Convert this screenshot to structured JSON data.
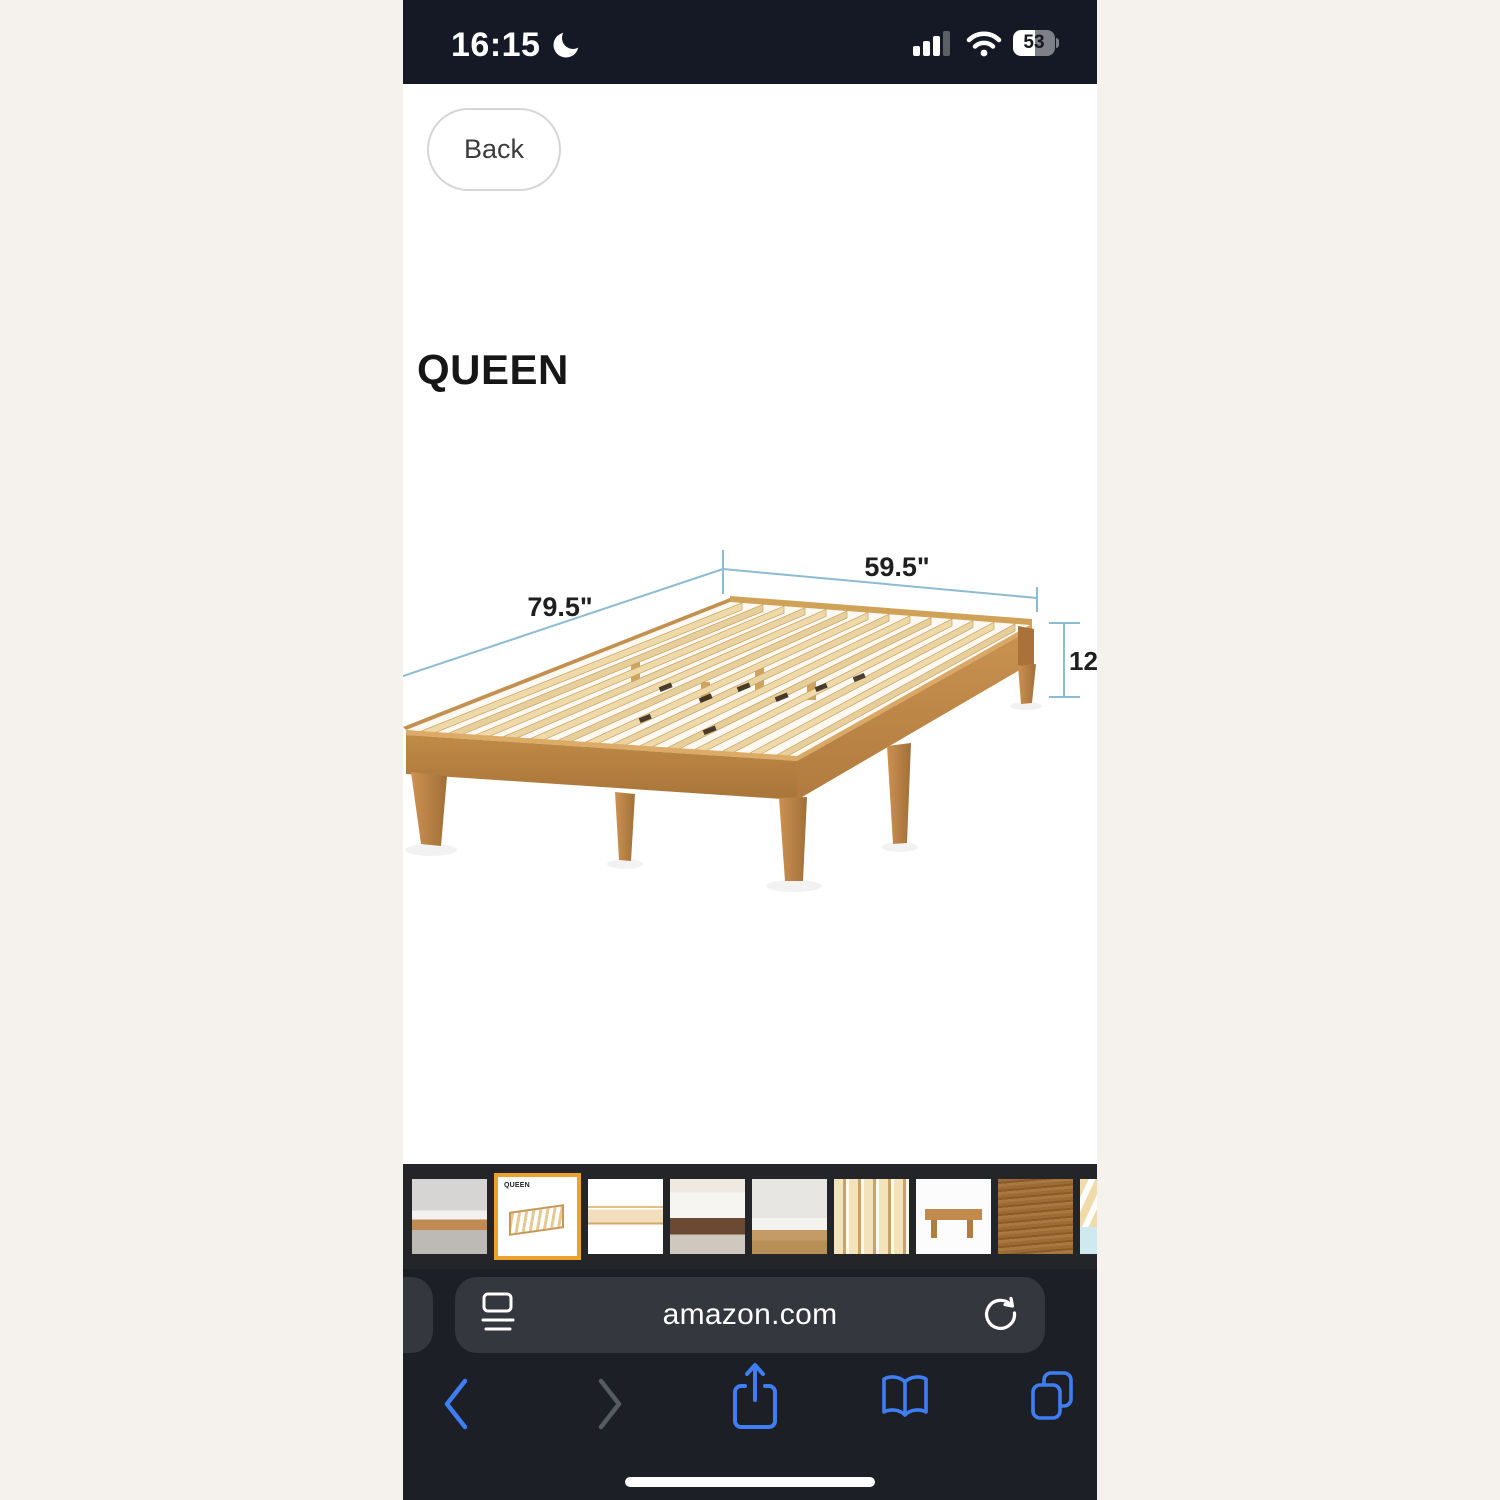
{
  "status_bar": {
    "time": "16:15",
    "battery_percent": "53"
  },
  "nav": {
    "back_label": "Back"
  },
  "product": {
    "size_title": "QUEEN"
  },
  "diagram": {
    "length_label": "79.5\"",
    "width_label": "59.5\"",
    "height_label": "12\""
  },
  "thumbnails": {
    "selected_index": 1,
    "items": [
      {
        "name": "bed-in-bedroom"
      },
      {
        "name": "dimension-diagram",
        "label": "QUEEN"
      },
      {
        "name": "bed-frame-white"
      },
      {
        "name": "bed-with-underbed-storage"
      },
      {
        "name": "bed-by-window"
      },
      {
        "name": "slats-closeup"
      },
      {
        "name": "frame-end-view"
      },
      {
        "name": "wood-grain-closeup"
      },
      {
        "name": "slats-detail-partial"
      }
    ]
  },
  "browser": {
    "url": "amazon.com"
  },
  "colors": {
    "accent_blue": "#3f7df2",
    "selected_border": "#efa12d",
    "dimension_line": "#8cbbd2",
    "status_bar_bg": "#141925",
    "chrome_bg": "#1c1f26",
    "wood_rail": "#bd853f",
    "wood_slat": "#ecd8a6"
  }
}
